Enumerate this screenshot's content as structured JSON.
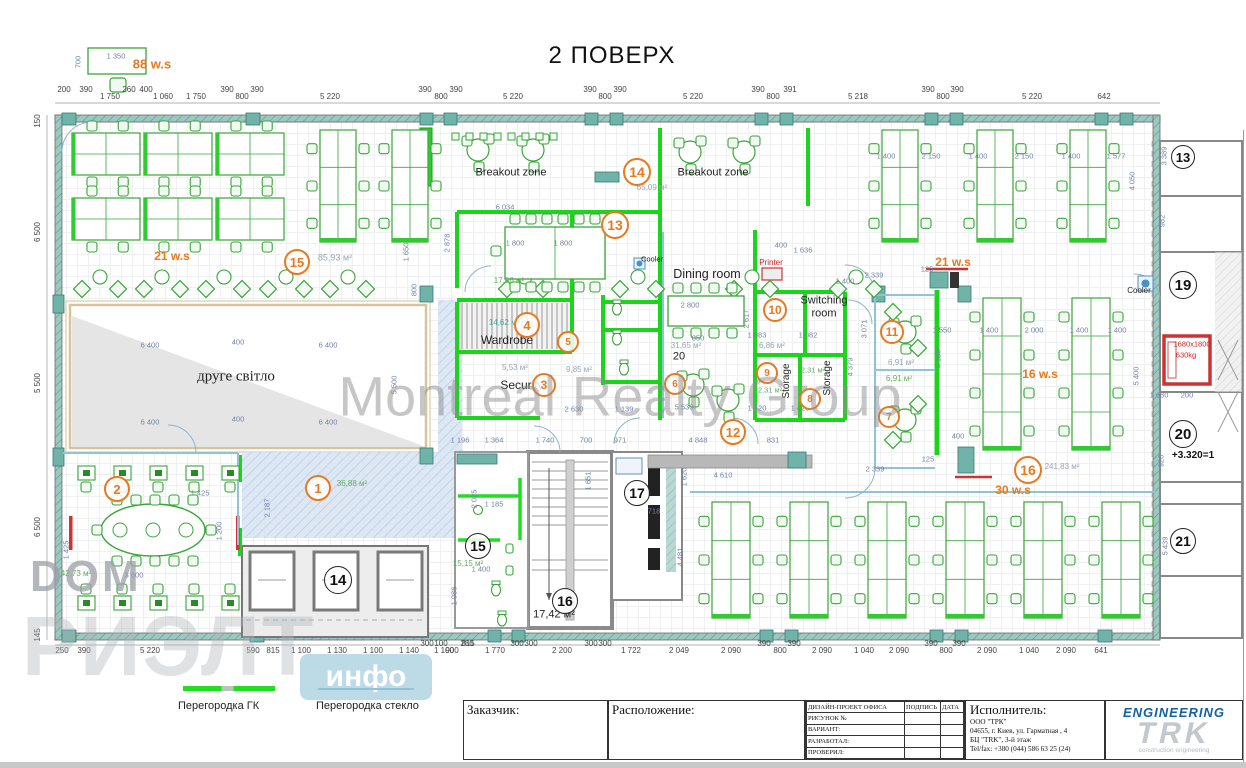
{
  "title": "2 ПОВЕРХ",
  "watermarks": {
    "center": "Montreal Realty Group",
    "corner": "DOM",
    "corner_big": "РИЭЛТ",
    "corner_badge": "инфо"
  },
  "legend": {
    "gk": "Перегородка ГК",
    "glass": "Перегородка стекло"
  },
  "title_block": {
    "customer_label": "Заказчик:",
    "location_label": "Расположение:",
    "project_label": "ДИЗАЙН-ПРОЕКТ ОФИСА",
    "sign_label": "ПОДПИСЬ",
    "date_label": "ДАТА",
    "rows": [
      "РИСУНОК №",
      "ВАРИАНТ:",
      "РАЗРАБОТАЛ:",
      "ПРОВЕРИЛ:"
    ],
    "executor_label": "Исполнитель:",
    "executor_lines": [
      "ООО \"ТРК\"",
      "04655, г. Киев, ул. Гарматная , 4",
      "БЦ \"TRK\",  3-й этаж",
      "Tel/fax: +380 (044) 586 63 25 (24)"
    ]
  },
  "logo": {
    "engineering": "ENGINEERING",
    "trk": "TRK",
    "sub": "construction engineering"
  },
  "colors": {
    "partition_gk": "#22dd22",
    "partition_glass": "#8fc3d8",
    "accent_orange": "#e8791e",
    "wall_teal": "#6fb3a9",
    "alert_red": "#cc3333",
    "lobby_hatch": "#d8e4f2"
  },
  "plan": {
    "labels": [
      {
        "t": "88 w.s",
        "x": 152,
        "y": 64,
        "c": "or",
        "s": 13
      },
      {
        "t": "21 w.s",
        "x": 172,
        "y": 256,
        "c": "or",
        "s": 12
      },
      {
        "t": "85,93 м²",
        "x": 335,
        "y": 258,
        "c": "area",
        "s": 9
      },
      {
        "t": "Breakout zone",
        "x": 511,
        "y": 173,
        "c": "",
        "s": 11
      },
      {
        "t": "Breakout zone",
        "x": 713,
        "y": 173,
        "c": "",
        "s": 11
      },
      {
        "t": "65,09 м²",
        "x": 652,
        "y": 188,
        "c": "area",
        "s": 8
      },
      {
        "t": "17,06 м²",
        "x": 509,
        "y": 281,
        "c": "areaG",
        "s": 8
      },
      {
        "t": "Cooler",
        "x": 652,
        "y": 259,
        "c": "",
        "s": 7.5
      },
      {
        "t": "Dining room",
        "x": 707,
        "y": 274,
        "c": "",
        "s": 12.5
      },
      {
        "t": "31,65 м²",
        "x": 686,
        "y": 346,
        "c": "area",
        "s": 8
      },
      {
        "t": "20",
        "x": 679,
        "y": 357,
        "c": "",
        "s": 11
      },
      {
        "t": "Printer",
        "x": 771,
        "y": 263,
        "c": "red",
        "s": 8
      },
      {
        "t": "Switching",
        "x": 824,
        "y": 301,
        "c": "",
        "s": 11
      },
      {
        "t": "room",
        "x": 824,
        "y": 314,
        "c": "",
        "s": 11
      },
      {
        "t": "6,86 м²",
        "x": 772,
        "y": 346,
        "c": "area",
        "s": 8
      },
      {
        "t": "14,62 м²",
        "x": 504,
        "y": 323,
        "c": "areaT",
        "s": 8
      },
      {
        "t": "Wardrobe",
        "x": 507,
        "y": 340,
        "c": "",
        "s": 12
      },
      {
        "t": "5,53 м²",
        "x": 515,
        "y": 368,
        "c": "area",
        "s": 8
      },
      {
        "t": "Security",
        "x": 522,
        "y": 385,
        "c": "",
        "s": 12
      },
      {
        "t": "9,85 м²",
        "x": 579,
        "y": 370,
        "c": "area",
        "s": 8
      },
      {
        "t": "Storage",
        "x": 787,
        "y": 381,
        "c": "",
        "s": 10,
        "r": -90
      },
      {
        "t": "Storage",
        "x": 828,
        "y": 378,
        "c": "",
        "s": 10,
        "r": -90
      },
      {
        "t": "2,31 м²",
        "x": 770,
        "y": 390,
        "c": "areaG",
        "s": 7.5
      },
      {
        "t": "2,31 м²",
        "x": 813,
        "y": 370,
        "c": "areaG",
        "s": 7.5
      },
      {
        "t": "друге світло",
        "x": 236,
        "y": 377,
        "c": "serif",
        "s": 15
      },
      {
        "t": "36,88 м²",
        "x": 352,
        "y": 484,
        "c": "areaG",
        "s": 8
      },
      {
        "t": "42,73 м²",
        "x": 76,
        "y": 574,
        "c": "areaG",
        "s": 8
      },
      {
        "t": "15,15 м²",
        "x": 468,
        "y": 564,
        "c": "areaG",
        "s": 8
      },
      {
        "t": "17,42 м²",
        "x": 554,
        "y": 615,
        "c": "",
        "s": 11
      },
      {
        "t": "21 w.s",
        "x": 953,
        "y": 262,
        "c": "or",
        "s": 12
      },
      {
        "t": "16 w.s",
        "x": 1040,
        "y": 374,
        "c": "or",
        "s": 12
      },
      {
        "t": "6,91 м²",
        "x": 901,
        "y": 363,
        "c": "area",
        "s": 8
      },
      {
        "t": "6,91 м²",
        "x": 899,
        "y": 379,
        "c": "areaG",
        "s": 8
      },
      {
        "t": "241,83 м²",
        "x": 1062,
        "y": 467,
        "c": "area",
        "s": 8
      },
      {
        "t": "30 w.s",
        "x": 1013,
        "y": 490,
        "c": "or",
        "s": 12
      },
      {
        "t": "Cooler",
        "x": 1139,
        "y": 291,
        "c": "",
        "s": 8
      },
      {
        "t": "1680x1800",
        "x": 1192,
        "y": 344,
        "c": "red",
        "s": 7.5
      },
      {
        "t": "630kg",
        "x": 1186,
        "y": 355,
        "c": "red",
        "s": 7.5
      },
      {
        "t": "+3.320=1",
        "x": 1193,
        "y": 456,
        "c": "lvl",
        "s": 10
      }
    ],
    "markers_orange": [
      {
        "n": "1",
        "x": 318,
        "y": 488,
        "d": 22
      },
      {
        "n": "2",
        "x": 117,
        "y": 489,
        "d": 22
      },
      {
        "n": "3",
        "x": 544,
        "y": 385,
        "d": 20
      },
      {
        "n": "4",
        "x": 527,
        "y": 325,
        "d": 22
      },
      {
        "n": "5",
        "x": 568,
        "y": 342,
        "d": 18
      },
      {
        "n": "6",
        "x": 675,
        "y": 384,
        "d": 18
      },
      {
        "n": "7",
        "x": 889,
        "y": 417,
        "d": 18
      },
      {
        "n": "8",
        "x": 810,
        "y": 399,
        "d": 18
      },
      {
        "n": "9",
        "x": 767,
        "y": 373,
        "d": 18
      },
      {
        "n": "10",
        "x": 775,
        "y": 310,
        "d": 20
      },
      {
        "n": "11",
        "x": 892,
        "y": 332,
        "d": 20
      },
      {
        "n": "12",
        "x": 733,
        "y": 432,
        "d": 22
      },
      {
        "n": "13",
        "x": 615,
        "y": 225,
        "d": 24
      },
      {
        "n": "14",
        "x": 637,
        "y": 172,
        "d": 24
      },
      {
        "n": "15",
        "x": 297,
        "y": 262,
        "d": 22
      },
      {
        "n": "16",
        "x": 1028,
        "y": 470,
        "d": 24
      }
    ],
    "markers_black": [
      {
        "n": "14",
        "x": 338,
        "y": 580,
        "d": 26
      },
      {
        "n": "15",
        "x": 478,
        "y": 546,
        "d": 24
      },
      {
        "n": "16",
        "x": 565,
        "y": 601,
        "d": 24
      },
      {
        "n": "17",
        "x": 637,
        "y": 493,
        "d": 24
      },
      {
        "n": "13",
        "x": 1183,
        "y": 157,
        "d": 22
      },
      {
        "n": "19",
        "x": 1183,
        "y": 285,
        "d": 26
      },
      {
        "n": "20",
        "x": 1183,
        "y": 434,
        "d": 26
      },
      {
        "n": "21",
        "x": 1183,
        "y": 541,
        "d": 24
      }
    ],
    "dims_top": [
      {
        "t": "200",
        "x": 64,
        "u": 1
      },
      {
        "t": "390",
        "x": 86,
        "u": 1
      },
      {
        "t": "1 750",
        "x": 110
      },
      {
        "t": "260",
        "x": 129,
        "u": 1
      },
      {
        "t": "400",
        "x": 146,
        "u": 1
      },
      {
        "t": "1 060",
        "x": 163
      },
      {
        "t": "1 750",
        "x": 196
      },
      {
        "t": "390",
        "x": 227,
        "u": 1
      },
      {
        "t": "800",
        "x": 242
      },
      {
        "t": "390",
        "x": 257,
        "u": 1
      },
      {
        "t": "5 220",
        "x": 330
      },
      {
        "t": "390",
        "x": 425,
        "u": 1
      },
      {
        "t": "800",
        "x": 441
      },
      {
        "t": "390",
        "x": 456,
        "u": 1
      },
      {
        "t": "5 220",
        "x": 513
      },
      {
        "t": "390",
        "x": 590,
        "u": 1
      },
      {
        "t": "800",
        "x": 605
      },
      {
        "t": "390",
        "x": 620,
        "u": 1
      },
      {
        "t": "5 220",
        "x": 693
      },
      {
        "t": "390",
        "x": 758,
        "u": 1
      },
      {
        "t": "800",
        "x": 773
      },
      {
        "t": "391",
        "x": 790,
        "u": 1
      },
      {
        "t": "5 218",
        "x": 858
      },
      {
        "t": "390",
        "x": 928,
        "u": 1
      },
      {
        "t": "800",
        "x": 943
      },
      {
        "t": "390",
        "x": 957,
        "u": 1
      },
      {
        "t": "5 220",
        "x": 1032
      },
      {
        "t": "642",
        "x": 1104
      }
    ],
    "dims_bottom": [
      {
        "t": "250",
        "x": 62
      },
      {
        "t": "390",
        "x": 84
      },
      {
        "t": "5 220",
        "x": 150
      },
      {
        "t": "590",
        "x": 253
      },
      {
        "t": "815",
        "x": 273
      },
      {
        "t": "1 100",
        "x": 301
      },
      {
        "t": "1 130",
        "x": 337
      },
      {
        "t": "1 100",
        "x": 373
      },
      {
        "t": "1 140",
        "x": 409
      },
      {
        "t": "1 100",
        "x": 444
      },
      {
        "t": "815",
        "x": 468,
        "u": 1
      },
      {
        "t": "300",
        "x": 427,
        "u": 1
      },
      {
        "t": "100",
        "x": 441,
        "u": 1
      },
      {
        "t": "900",
        "x": 452
      },
      {
        "t": "280",
        "x": 467,
        "u": 1
      },
      {
        "t": "1 770",
        "x": 495
      },
      {
        "t": "300",
        "x": 517,
        "u": 1
      },
      {
        "t": "300",
        "x": 531,
        "u": 1
      },
      {
        "t": "2 200",
        "x": 562
      },
      {
        "t": "300",
        "x": 591,
        "u": 1
      },
      {
        "t": "300",
        "x": 605,
        "u": 1
      },
      {
        "t": "1 722",
        "x": 631
      },
      {
        "t": "2 049",
        "x": 679
      },
      {
        "t": "2 090",
        "x": 731
      },
      {
        "t": "390",
        "x": 764,
        "u": 1
      },
      {
        "t": "800",
        "x": 780
      },
      {
        "t": "390",
        "x": 794,
        "u": 1
      },
      {
        "t": "2 090",
        "x": 822
      },
      {
        "t": "1 040",
        "x": 864
      },
      {
        "t": "2 090",
        "x": 899
      },
      {
        "t": "390",
        "x": 931,
        "u": 1
      },
      {
        "t": "800",
        "x": 946
      },
      {
        "t": "390",
        "x": 959,
        "u": 1
      },
      {
        "t": "2 090",
        "x": 987
      },
      {
        "t": "1 040",
        "x": 1029
      },
      {
        "t": "2 090",
        "x": 1066
      },
      {
        "t": "641",
        "x": 1101
      }
    ],
    "dims_left": [
      {
        "t": "150",
        "y": 121
      },
      {
        "t": "6 500",
        "y": 232
      },
      {
        "t": "5 500",
        "y": 383
      },
      {
        "t": "6 500",
        "y": 527
      },
      {
        "t": "145",
        "y": 635
      }
    ],
    "dims_inner": [
      {
        "t": "1 350",
        "x": 116,
        "y": 56
      },
      {
        "t": "700",
        "x": 78,
        "y": 62,
        "v": 1
      },
      {
        "t": "6 034",
        "x": 505,
        "y": 207
      },
      {
        "t": "2 878",
        "x": 447,
        "y": 243,
        "v": 1
      },
      {
        "t": "1 650",
        "x": 406,
        "y": 252,
        "v": 1
      },
      {
        "t": "800",
        "x": 414,
        "y": 290,
        "v": 1
      },
      {
        "t": "6 400",
        "x": 150,
        "y": 345
      },
      {
        "t": "400",
        "x": 238,
        "y": 342
      },
      {
        "t": "6 400",
        "x": 328,
        "y": 345
      },
      {
        "t": "6 400",
        "x": 150,
        "y": 422
      },
      {
        "t": "400",
        "x": 238,
        "y": 419
      },
      {
        "t": "6 400",
        "x": 328,
        "y": 422
      },
      {
        "t": "5 500",
        "x": 394,
        "y": 385,
        "v": 1
      },
      {
        "t": "2 187",
        "x": 267,
        "y": 508,
        "v": 1
      },
      {
        "t": "1 425",
        "x": 200,
        "y": 493
      },
      {
        "t": "1 425",
        "x": 66,
        "y": 550,
        "v": 1
      },
      {
        "t": "3 600",
        "x": 134,
        "y": 575
      },
      {
        "t": "1 200",
        "x": 219,
        "y": 531,
        "v": 1
      },
      {
        "t": "1 800",
        "x": 515,
        "y": 243
      },
      {
        "t": "1 800",
        "x": 563,
        "y": 243
      },
      {
        "t": "2 800",
        "x": 690,
        "y": 305
      },
      {
        "t": "850",
        "x": 698,
        "y": 338
      },
      {
        "t": "400",
        "x": 781,
        "y": 245
      },
      {
        "t": "1 636",
        "x": 803,
        "y": 250
      },
      {
        "t": "1 400",
        "x": 845,
        "y": 281
      },
      {
        "t": "2 617",
        "x": 746,
        "y": 319,
        "v": 1
      },
      {
        "t": "1 083",
        "x": 757,
        "y": 335
      },
      {
        "t": "1 082",
        "x": 808,
        "y": 335
      },
      {
        "t": "4 379",
        "x": 850,
        "y": 367,
        "v": 1
      },
      {
        "t": "3 071",
        "x": 864,
        "y": 329,
        "v": 1
      },
      {
        "t": "1 400",
        "x": 886,
        "y": 156
      },
      {
        "t": "2 150",
        "x": 931,
        "y": 156
      },
      {
        "t": "1 400",
        "x": 978,
        "y": 156
      },
      {
        "t": "2 150",
        "x": 1024,
        "y": 156
      },
      {
        "t": "1 400",
        "x": 1071,
        "y": 156
      },
      {
        "t": "1 577",
        "x": 1116,
        "y": 156
      },
      {
        "t": "4 050",
        "x": 1132,
        "y": 181,
        "v": 1
      },
      {
        "t": "2 339",
        "x": 874,
        "y": 275
      },
      {
        "t": "125",
        "x": 927,
        "y": 269
      },
      {
        "t": "1 550",
        "x": 942,
        "y": 330
      },
      {
        "t": "1 400",
        "x": 989,
        "y": 330
      },
      {
        "t": "2 000",
        "x": 1034,
        "y": 330
      },
      {
        "t": "1 400",
        "x": 1079,
        "y": 330
      },
      {
        "t": "1 400",
        "x": 1117,
        "y": 330
      },
      {
        "t": "6 189",
        "x": 938,
        "y": 359,
        "v": 1
      },
      {
        "t": "5 400",
        "x": 1136,
        "y": 376,
        "v": 1
      },
      {
        "t": "2 339",
        "x": 875,
        "y": 469
      },
      {
        "t": "125",
        "x": 928,
        "y": 459
      },
      {
        "t": "400",
        "x": 958,
        "y": 436
      },
      {
        "t": "2 630",
        "x": 574,
        "y": 409
      },
      {
        "t": "1 139",
        "x": 624,
        "y": 409
      },
      {
        "t": "5 530",
        "x": 684,
        "y": 407
      },
      {
        "t": "1 420",
        "x": 757,
        "y": 408
      },
      {
        "t": "1 420",
        "x": 800,
        "y": 408
      },
      {
        "t": "1 196",
        "x": 460,
        "y": 440
      },
      {
        "t": "1 364",
        "x": 494,
        "y": 440
      },
      {
        "t": "1 740",
        "x": 545,
        "y": 440
      },
      {
        "t": "700",
        "x": 586,
        "y": 440
      },
      {
        "t": "971",
        "x": 620,
        "y": 440
      },
      {
        "t": "4 848",
        "x": 698,
        "y": 440
      },
      {
        "t": "831",
        "x": 773,
        "y": 440
      },
      {
        "t": "4 610",
        "x": 723,
        "y": 475
      },
      {
        "t": "1 651",
        "x": 588,
        "y": 481,
        "v": 1
      },
      {
        "t": "2 025",
        "x": 474,
        "y": 499,
        "v": 1
      },
      {
        "t": "1 185",
        "x": 494,
        "y": 504
      },
      {
        "t": "1 400",
        "x": 481,
        "y": 569
      },
      {
        "t": "1 986",
        "x": 454,
        "y": 596,
        "v": 1
      },
      {
        "t": "4 481",
        "x": 680,
        "y": 557,
        "v": 1
      },
      {
        "t": "1 620",
        "x": 684,
        "y": 477,
        "v": 1
      },
      {
        "t": "718",
        "x": 654,
        "y": 511
      },
      {
        "t": "1 680",
        "x": 1159,
        "y": 395
      },
      {
        "t": "200",
        "x": 1187,
        "y": 395
      },
      {
        "t": "982",
        "x": 1162,
        "y": 221,
        "v": 1
      },
      {
        "t": "3 389",
        "x": 1164,
        "y": 156,
        "v": 1
      },
      {
        "t": "920",
        "x": 1161,
        "y": 461,
        "v": 1
      },
      {
        "t": "5 439",
        "x": 1165,
        "y": 546,
        "v": 1
      }
    ]
  }
}
